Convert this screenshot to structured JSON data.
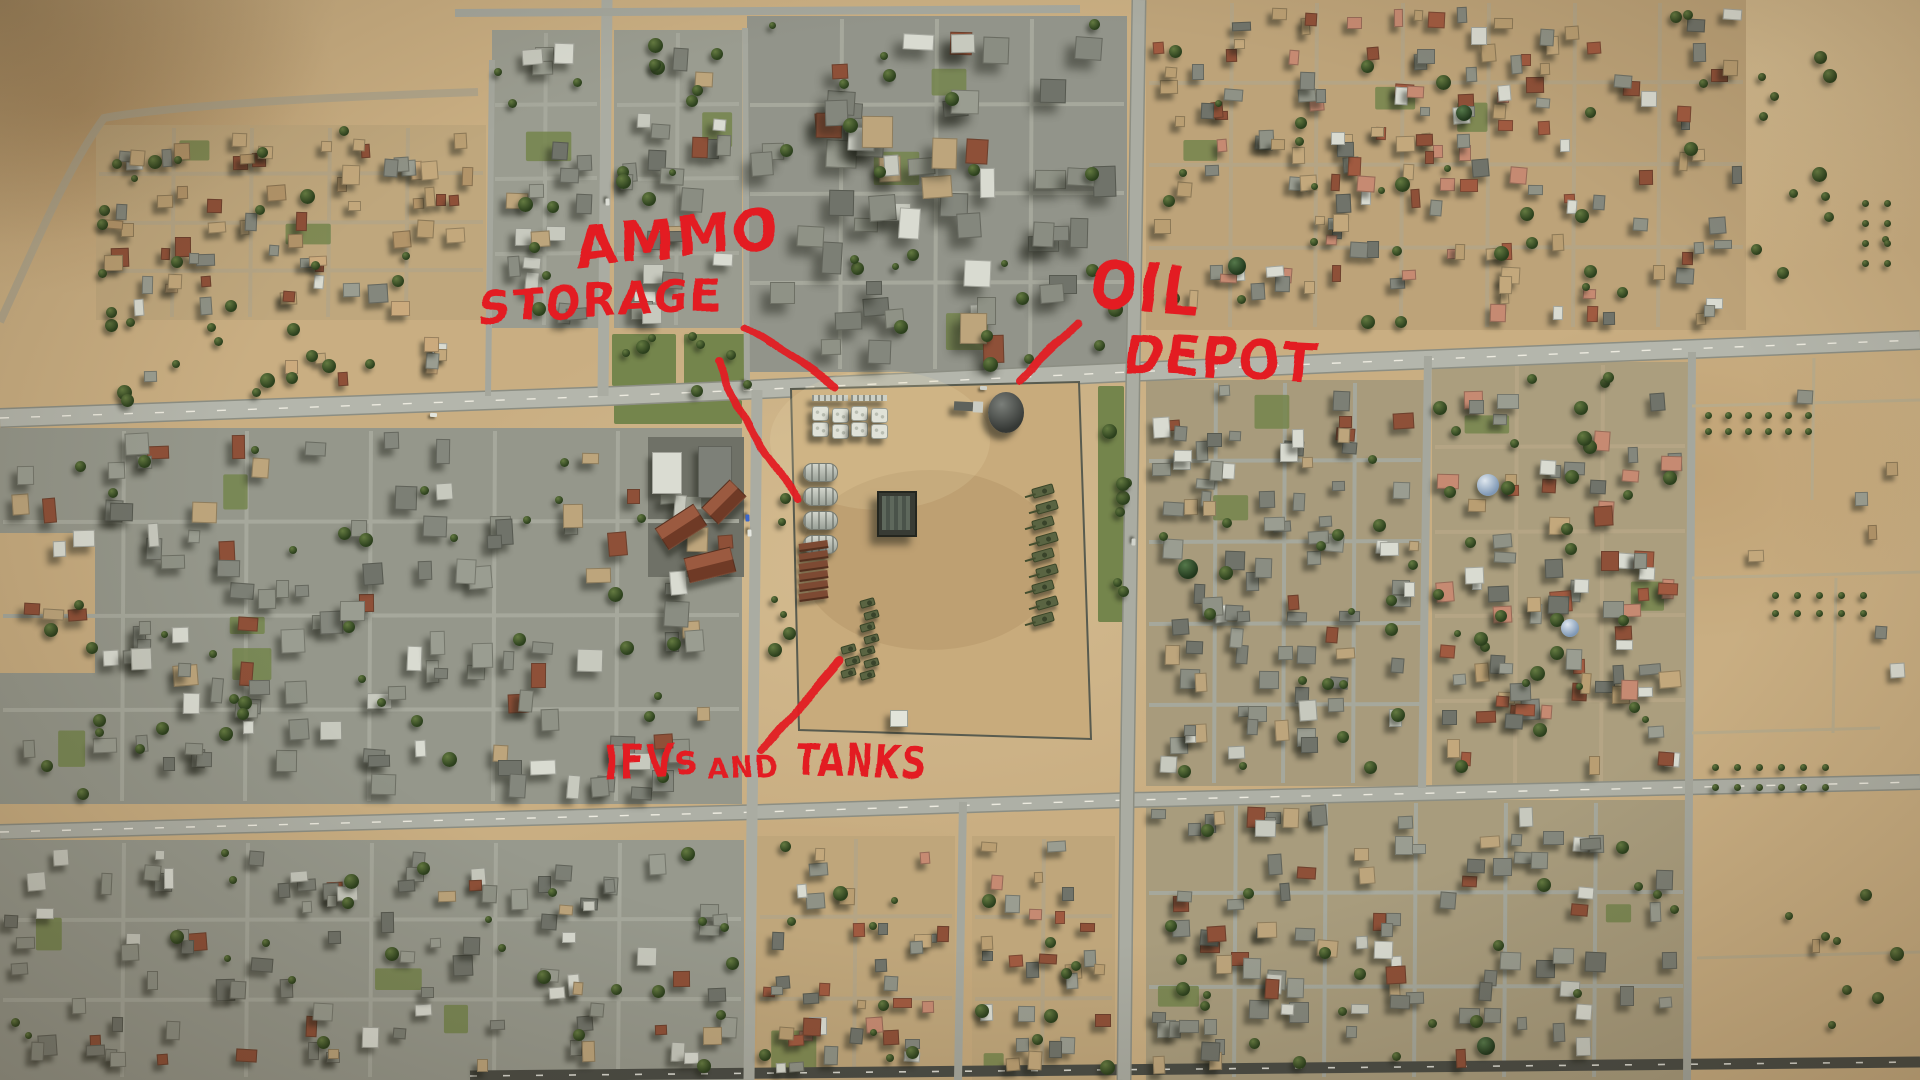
{
  "scene": {
    "description": "Annotated aerial reconnaissance view of a desert city with a fenced military compound",
    "annotation_ink": "#e31b22",
    "palette": {
      "desert": "#c9ae82",
      "urban_ground": "#95978b",
      "road": "#b4b6ac",
      "grass": "#74854c",
      "tree": "#2c401d",
      "fence": "#585b4f",
      "armor_vehicle": "#5a6442",
      "revetment": "#7d4a33",
      "oil_tank": "#3a3d3a"
    }
  },
  "annotations": {
    "labels": [
      {
        "id": "ammo-storage",
        "words": [
          {
            "t": "AMMO",
            "x": 574,
            "y": 214,
            "s": 58,
            "r": -6,
            "sx": 0.95
          },
          {
            "t": "STORAGE",
            "x": 479,
            "y": 280,
            "s": 46,
            "r": -3,
            "sx": 0.95
          }
        ]
      },
      {
        "id": "oil-depot",
        "words": [
          {
            "t": "OIL",
            "x": 1096,
            "y": 246,
            "s": 66,
            "r": 5,
            "sx": 0.85
          },
          {
            "t": "DEPOT",
            "x": 1128,
            "y": 322,
            "s": 54,
            "r": 3,
            "sx": 0.9
          }
        ]
      },
      {
        "id": "ifvs-and-tanks",
        "words": [
          {
            "t": "IFVs",
            "x": 604,
            "y": 736,
            "s": 46,
            "r": -3,
            "sx": 0.8
          },
          {
            "t": "AND",
            "x": 708,
            "y": 750,
            "s": 32,
            "r": -2,
            "sx": 0.85
          },
          {
            "t": "TANKS",
            "x": 798,
            "y": 736,
            "s": 43,
            "r": 1,
            "sx": 0.78
          }
        ]
      }
    ],
    "pointer_lines": [
      {
        "id": "ammo-storage-line",
        "d": "M 743,326 Q 792,355 835,387"
      },
      {
        "id": "storage-compound-line",
        "d": "M 718,361 C 733,402 760,448 777,469 C 789,484 797,492 799,499"
      },
      {
        "id": "oil-depot-line",
        "d": "M 1019,382 Q 1048,352 1080,323"
      },
      {
        "id": "tanks-line",
        "d": "M 762,750 Q 799,707 839,661"
      }
    ]
  },
  "compound": {
    "fence": "791,389 1079,382 1091,739 799,730",
    "features": [
      {
        "id": "ammo-shelter-cluster-1",
        "type": "shelters",
        "x": 812,
        "y": 395,
        "w": 36,
        "h": 52
      },
      {
        "id": "ammo-shelter-cluster-2",
        "type": "shelters",
        "x": 851,
        "y": 395,
        "w": 36,
        "h": 52
      },
      {
        "id": "oil-storage-tank",
        "type": "tank",
        "x": 988,
        "y": 392,
        "w": 36,
        "h": 41
      },
      {
        "id": "supply-truck",
        "type": "truck",
        "x": 954,
        "y": 399,
        "w": 29,
        "h": 15
      },
      {
        "id": "fuel-cylinder-row",
        "type": "cylcol",
        "x": 803,
        "y": 463,
        "w": 33,
        "h": 17,
        "count": 4,
        "dy": 24
      },
      {
        "id": "revetment-row",
        "type": "revcol",
        "x": 799,
        "y": 542,
        "w": 29,
        "h": 6,
        "count": 6,
        "dy": 10
      },
      {
        "id": "storage-building",
        "type": "building",
        "x": 877,
        "y": 491,
        "w": 40,
        "h": 46
      },
      {
        "id": "armor-column-east",
        "type": "vehcol",
        "x": 1034,
        "y": 486,
        "w": 22,
        "h": 10,
        "count": 9,
        "dy": 16
      },
      {
        "id": "armor-column-south-1",
        "type": "vehcol",
        "x": 862,
        "y": 599,
        "w": 15,
        "h": 8,
        "count": 7,
        "dy": 12
      },
      {
        "id": "armor-column-south-2",
        "type": "vehcol",
        "x": 843,
        "y": 645,
        "w": 15,
        "h": 8,
        "count": 3,
        "dy": 12
      },
      {
        "id": "gate-hut",
        "type": "hut",
        "x": 890,
        "y": 710,
        "w": 18,
        "h": 17
      }
    ]
  },
  "landmarks": [
    {
      "id": "mosque-dome",
      "style": "green",
      "x": 1237,
      "y": 266,
      "r": 9
    },
    {
      "id": "mosque-dome",
      "style": "green",
      "x": 1188,
      "y": 569,
      "r": 10
    },
    {
      "id": "mosque-dome",
      "style": "green",
      "x": 1464,
      "y": 113,
      "r": 8
    },
    {
      "id": "mosque-dome",
      "style": "blue",
      "x": 1488,
      "y": 485,
      "r": 11
    },
    {
      "id": "mosque-dome",
      "style": "blue",
      "x": 1570,
      "y": 628,
      "r": 9
    },
    {
      "id": "mosque-dome",
      "style": "green",
      "x": 1486,
      "y": 1046,
      "r": 9
    }
  ]
}
